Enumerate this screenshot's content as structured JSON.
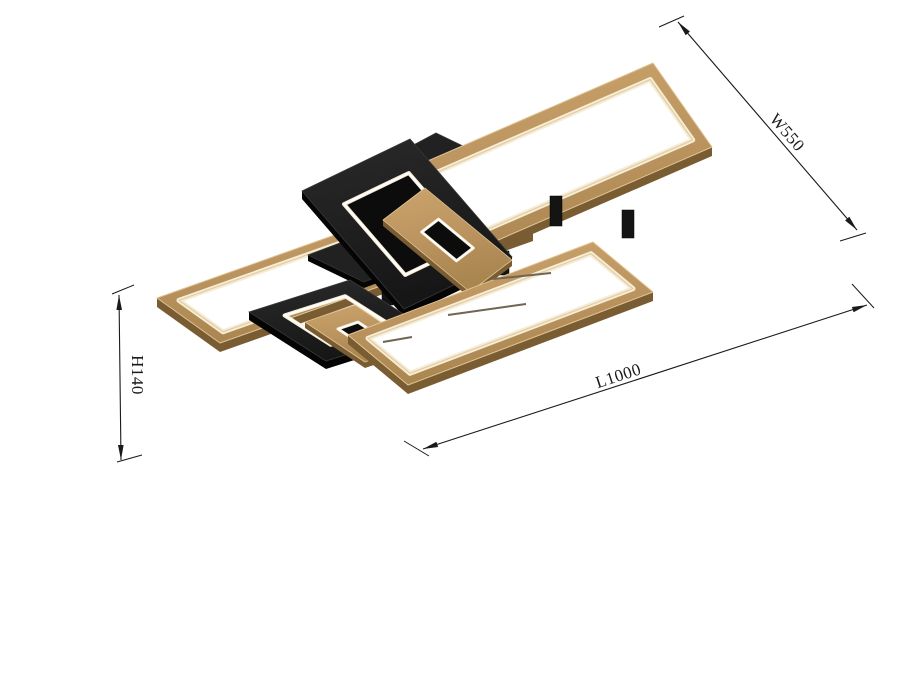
{
  "dimensions": {
    "width": {
      "label": "W550",
      "line": [
        [
          678,
          22
        ],
        [
          857,
          230
        ]
      ],
      "ticks": [
        [
          [
            659,
            27
          ],
          [
            684,
            16
          ]
        ],
        [
          [
            840,
            241
          ],
          [
            866,
            233
          ]
        ]
      ]
    },
    "length": {
      "label": "L1000",
      "line": [
        [
          423,
          449
        ],
        [
          867,
          305
        ]
      ],
      "ticks": [
        [
          [
            404,
            441
          ],
          [
            429,
            456
          ]
        ],
        [
          [
            852,
            284
          ],
          [
            874,
            308
          ]
        ]
      ]
    },
    "height": {
      "label": "H140",
      "line": [
        [
          119,
          295
        ],
        [
          121,
          460
        ]
      ],
      "ticks": [
        [
          [
            112,
            294
          ],
          [
            134,
            285
          ]
        ],
        [
          [
            117,
            462
          ],
          [
            142,
            455
          ]
        ]
      ]
    }
  },
  "drawing": {
    "colors": {
      "line": "#1a1a1a",
      "woodTopA": "#CBA36C",
      "woodTopB": "#A9854F",
      "woodEdge": "#E0C494",
      "woodSide": "#7A5C33",
      "ledWhite": "#FFFFFF",
      "ledGlow": "#F6EDD8",
      "ledWarm": "#E4CEA1",
      "blackTop": "#1E1E1E",
      "blackSide": "#050505",
      "blackHi": "#383838",
      "holeDark": "#0C0C0C",
      "slit": "#6F6552"
    },
    "panels": [
      {
        "name": "back-panel",
        "quad": [
          [
            338,
            200
          ],
          [
            653,
            63
          ],
          [
            712,
            147
          ],
          [
            397,
            284
          ]
        ],
        "led": [
          0.035,
          0.965,
          0.14,
          0.86
        ]
      },
      {
        "name": "left-panel",
        "quad": [
          [
            157,
            298
          ],
          [
            470,
            187
          ],
          [
            533,
            232
          ],
          [
            220,
            343
          ]
        ],
        "led": [
          0.04,
          0.96,
          0.15,
          0.85
        ]
      },
      {
        "name": "front-panel",
        "quad": [
          [
            348,
            335
          ],
          [
            593,
            242
          ],
          [
            653,
            292
          ],
          [
            408,
            385
          ]
        ],
        "led": [
          0.045,
          0.955,
          0.15,
          0.85
        ]
      }
    ],
    "squares": [
      {
        "name": "upper-square-frame",
        "quad": [
          [
            302,
            191
          ],
          [
            410,
            139
          ],
          [
            512,
            257
          ],
          [
            404,
            309
          ]
        ],
        "hole": [
          0.2,
          0.8,
          0.2,
          0.8
        ],
        "holeFill": true,
        "sub": {
          "quad": [
            [
              383,
              220
            ],
            [
              425,
              188
            ],
            [
              512,
              260
            ],
            [
              470,
              292
            ]
          ],
          "hole": [
            0.3,
            0.7,
            0.3,
            0.7
          ]
        }
      },
      {
        "name": "lower-square-frame",
        "quad": [
          [
            249,
            312
          ],
          [
            350,
            280
          ],
          [
            427,
            329
          ],
          [
            326,
            361
          ]
        ],
        "hole": [
          0.2,
          0.8,
          0.2,
          0.8
        ],
        "holeFill": false,
        "sub": {
          "quad": [
            [
              305,
              322
            ],
            [
              355,
              305
            ],
            [
              415,
              345
            ],
            [
              365,
              362
            ]
          ],
          "hole": [
            0.3,
            0.7,
            0.3,
            0.7
          ]
        }
      }
    ],
    "canopies": [
      {
        "name": "ceiling-canopy-large",
        "quad": [
          [
            318,
            196
          ],
          [
            436,
            133
          ],
          [
            560,
            193
          ],
          [
            442,
            256
          ]
        ]
      },
      {
        "name": "ceiling-canopy-small",
        "quad": [
          [
            308,
            255
          ],
          [
            372,
            231
          ],
          [
            428,
            258
          ],
          [
            364,
            282
          ]
        ]
      }
    ],
    "stems": [
      [
        481,
        249,
        11,
        26
      ],
      [
        498,
        251,
        11,
        24
      ],
      [
        550,
        196,
        12,
        30
      ],
      [
        382,
        280,
        11,
        25
      ],
      [
        622,
        210,
        12,
        28
      ]
    ],
    "slits": [
      [
        [
          448,
          315
        ],
        [
          526,
          304
        ]
      ],
      [
        [
          493,
          279
        ],
        [
          551,
          273
        ]
      ],
      [
        [
          383,
          342
        ],
        [
          412,
          337
        ]
      ]
    ]
  }
}
